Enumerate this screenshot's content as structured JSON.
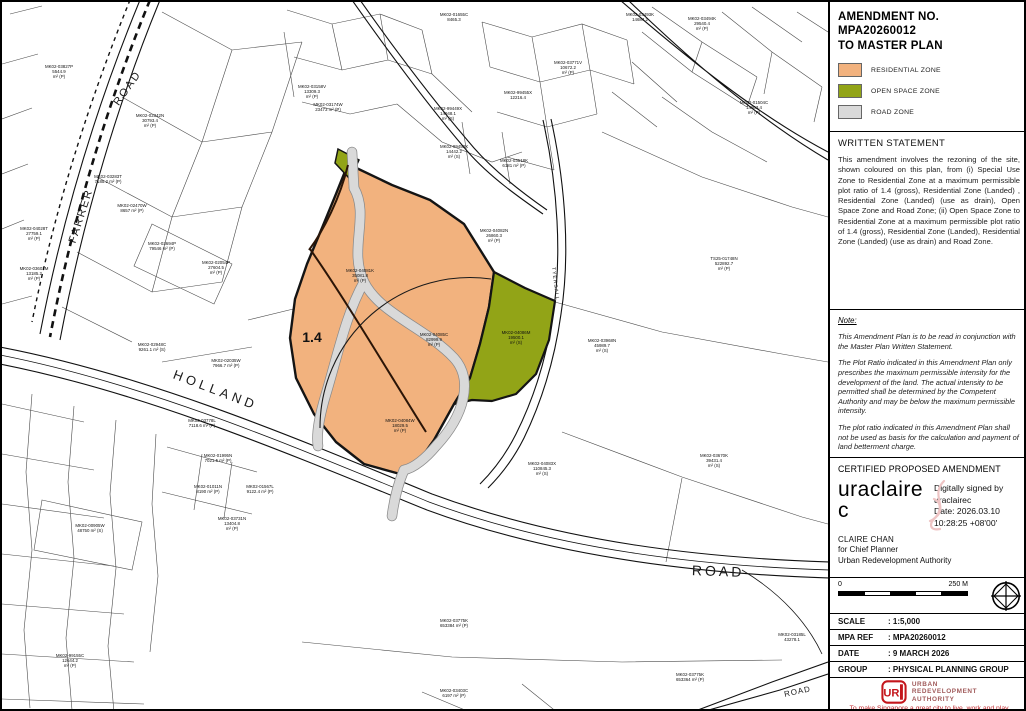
{
  "panel": {
    "title_line1": "AMENDMENT NO. MPA20260012",
    "title_line2": "TO MASTER PLAN",
    "legend": [
      {
        "label": "RESIDENTIAL ZONE",
        "color": "#f2b27e"
      },
      {
        "label": "OPEN SPACE ZONE",
        "color": "#92a417"
      },
      {
        "label": "ROAD ZONE",
        "color": "#d9d9d9"
      }
    ],
    "written_statement": {
      "heading": "WRITTEN STATEMENT",
      "body": "This amendment involves the rezoning of the site, shown coloured on this plan, from (i) Special Use Zone to Residential Zone at a maximum permissible plot ratio of 1.4 (gross), Residential Zone (Landed) , Residential Zone (Landed) (use as drain), Open Space Zone and Road Zone; (ii) Open Space Zone to Residential Zone at a maximum permissible plot ratio of 1.4 (gross), Residential Zone (Landed), Residential Zone (Landed) (use as drain) and Road Zone."
    },
    "note": {
      "heading": "Note:",
      "paragraphs": [
        "This Amendment Plan is to be read in conjunction with the Master Plan Written Statement.",
        "The Plot Ratio indicated in this Amendment Plan only prescribes the maximum permissible intensity for the development of the land. The actual intensity to be permitted shall be determined by the Competent Authority and may be below the maximum permissible intensity.",
        "The plot ratio indicated in this Amendment Plan shall not be used as basis for the calculation and payment of land betterment charge."
      ]
    },
    "certification": {
      "heading": "CERTIFIED PROPOSED AMENDMENT",
      "signature_line1": "uraclaire",
      "signature_line2": "c",
      "signature_details": [
        "Digitally signed by",
        "uraclairec",
        "Date: 2026.03.10",
        "10:28:25 +08'00'"
      ],
      "signatory": "CLAIRE CHAN",
      "signatory_title": "for Chief Planner",
      "signatory_org": "Urban Redevelopment Authority"
    },
    "scalebar": {
      "start": "0",
      "end": "250 M"
    },
    "table": [
      {
        "label": "SCALE",
        "value": ": 1:5,000"
      },
      {
        "label": "MPA REF",
        "value": ": MPA20260012"
      },
      {
        "label": "DATE",
        "value": ": 9 MARCH 2026"
      },
      {
        "label": "GROUP",
        "value": ": PHYSICAL PLANNING GROUP"
      }
    ],
    "ura": {
      "logo_text": "UR",
      "name_lines": [
        "Urban",
        "Redevelopment",
        "Authority"
      ],
      "tagline": "To make Singapore a great city to live, work and play"
    }
  },
  "map": {
    "zone_colors": {
      "residential": "#f2b27e",
      "open_space": "#92a417",
      "road": "#d9d9d9"
    },
    "road_labels": [
      {
        "text": "FARRER",
        "x": 82,
        "y": 215,
        "rot": -72,
        "size": 11,
        "spacing": 2
      },
      {
        "text": "ROAD",
        "x": 128,
        "y": 88,
        "rot": -55,
        "size": 11,
        "spacing": 2
      },
      {
        "text": "HOLLAND",
        "x": 212,
        "y": 392,
        "rot": 21,
        "size": 13,
        "spacing": 4
      },
      {
        "text": "ROAD",
        "x": 716,
        "y": 574,
        "rot": 2,
        "size": 14,
        "spacing": 3
      },
      {
        "text": "TYERSALL",
        "x": 552,
        "y": 282,
        "rot": 83,
        "size": 5,
        "spacing": 1
      },
      {
        "text": "ROAD",
        "x": 796,
        "y": 692,
        "rot": -12,
        "size": 8,
        "spacing": 1
      }
    ],
    "parcels": [
      {
        "lines": [
          "1.4"
        ],
        "x": 310,
        "y": 340,
        "size": 14,
        "bold": true
      },
      {
        "lines": [
          "MK02-04081K",
          "35081.8",
          "m² (P)"
        ],
        "x": 358,
        "y": 270
      },
      {
        "lines": [
          "MK02-04085C",
          "82999.9",
          "m² (P)"
        ],
        "x": 432,
        "y": 334
      },
      {
        "lines": [
          "MK02-04086M",
          "19500.1",
          "m² (S)"
        ],
        "x": 514,
        "y": 332
      },
      {
        "lines": [
          "MK02-04084W",
          "18029.5",
          "m² (P)"
        ],
        "x": 398,
        "y": 420
      },
      {
        "lines": [
          "MK02-04082N",
          "26860.3",
          "m² (P)"
        ],
        "x": 492,
        "y": 230
      },
      {
        "lines": [
          "MK02-04083X",
          "110845.3",
          "m² (S)"
        ],
        "x": 540,
        "y": 463
      },
      {
        "lines": [
          "MK02-03968N",
          "45989.7",
          "m² (S)"
        ],
        "x": 600,
        "y": 340
      },
      {
        "lines": [
          "TS25-01748N",
          "522892.7",
          "m² (P)"
        ],
        "x": 722,
        "y": 258
      },
      {
        "lines": [
          "MK02-03670K",
          "39431.4",
          "m² (S)"
        ],
        "x": 712,
        "y": 455
      },
      {
        "lines": [
          "MK02-02342N",
          "30793.4",
          "m² (P)"
        ],
        "x": 148,
        "y": 115
      },
      {
        "lines": [
          "MK02-03827P",
          "5544.9",
          "m² (P)"
        ],
        "x": 57,
        "y": 66
      },
      {
        "lines": [
          "MK02-03283T",
          "7185.2 m² (P)"
        ],
        "x": 106,
        "y": 176
      },
      {
        "lines": [
          "MK02-02470W",
          "8657 m² (P)"
        ],
        "x": 130,
        "y": 205
      },
      {
        "lines": [
          "MK02-04028T",
          "27759.1",
          "m² (P)"
        ],
        "x": 32,
        "y": 228
      },
      {
        "lines": [
          "MK02-03601M",
          "13185.2",
          "m² (P)"
        ],
        "x": 32,
        "y": 268
      },
      {
        "lines": [
          "MK02-03694P",
          "79546 m² (P)"
        ],
        "x": 160,
        "y": 243
      },
      {
        "lines": [
          "MK02-02054P",
          "27604.5",
          "m² (P)"
        ],
        "x": 214,
        "y": 262
      },
      {
        "lines": [
          "MK02-02948C",
          "9261.1 m² (S)"
        ],
        "x": 150,
        "y": 344
      },
      {
        "lines": [
          "MK02-02035W",
          "7966.7 m² (P)"
        ],
        "x": 224,
        "y": 360
      },
      {
        "lines": [
          "MK02-03778L",
          "7118.6 m² (P)"
        ],
        "x": 200,
        "y": 420
      },
      {
        "lines": [
          "MK02-01995N",
          "7021.5 m² (P)"
        ],
        "x": 216,
        "y": 455
      },
      {
        "lines": [
          "MK02-01011N",
          "8190 m² (P)"
        ],
        "x": 206,
        "y": 486
      },
      {
        "lines": [
          "MK02-01567L",
          "9122.4 m² (P)"
        ],
        "x": 258,
        "y": 486
      },
      {
        "lines": [
          "MK02-03731N",
          "13404.8",
          "m² (P)"
        ],
        "x": 230,
        "y": 518
      },
      {
        "lines": [
          "MK02-00905W",
          "48750 m² (S)"
        ],
        "x": 88,
        "y": 525
      },
      {
        "lines": [
          "MK02-99155C",
          "12644.2",
          "m² (P)"
        ],
        "x": 68,
        "y": 655
      },
      {
        "lines": [
          "MK02-03775K",
          "653384 m² (P)"
        ],
        "x": 452,
        "y": 620
      },
      {
        "lines": [
          "MK02-03775K",
          "653364 m² (P)"
        ],
        "x": 688,
        "y": 674
      },
      {
        "lines": [
          "MK02-03403C",
          "6197 m² (P)"
        ],
        "x": 452,
        "y": 690
      },
      {
        "lines": [
          "MK02-03185L",
          "43278.1"
        ],
        "x": 790,
        "y": 634
      },
      {
        "lines": [
          "MK02-99449X",
          "14948.1",
          "m² (S)"
        ],
        "x": 446,
        "y": 108
      },
      {
        "lines": [
          "MK02-99450X",
          "14442.2",
          "m² (S)"
        ],
        "x": 452,
        "y": 146
      },
      {
        "lines": [
          "MK02-03518K",
          "6181 m² (P)"
        ],
        "x": 512,
        "y": 160
      },
      {
        "lines": [
          "MK02-99455X",
          "12216.4"
        ],
        "x": 516,
        "y": 92
      },
      {
        "lines": [
          "MK02-03494K",
          "29540.4",
          "m² (P)"
        ],
        "x": 700,
        "y": 18
      },
      {
        "lines": [
          "MK02-03493K",
          "14684.2"
        ],
        "x": 638,
        "y": 14
      },
      {
        "lines": [
          "MK02-01655C",
          "8465.3"
        ],
        "x": 452,
        "y": 14
      },
      {
        "lines": [
          "MK02-03771V",
          "10672.2",
          "m² (P)"
        ],
        "x": 566,
        "y": 62
      },
      {
        "lines": [
          "MK02-01504C",
          "14603.4",
          "m² (P)"
        ],
        "x": 752,
        "y": 102
      },
      {
        "lines": [
          "MK02-03158V",
          "13309.3",
          "m² (P)"
        ],
        "x": 310,
        "y": 86
      },
      {
        "lines": [
          "MK02-03174W",
          "23473 m² (P)"
        ],
        "x": 326,
        "y": 104
      }
    ]
  }
}
